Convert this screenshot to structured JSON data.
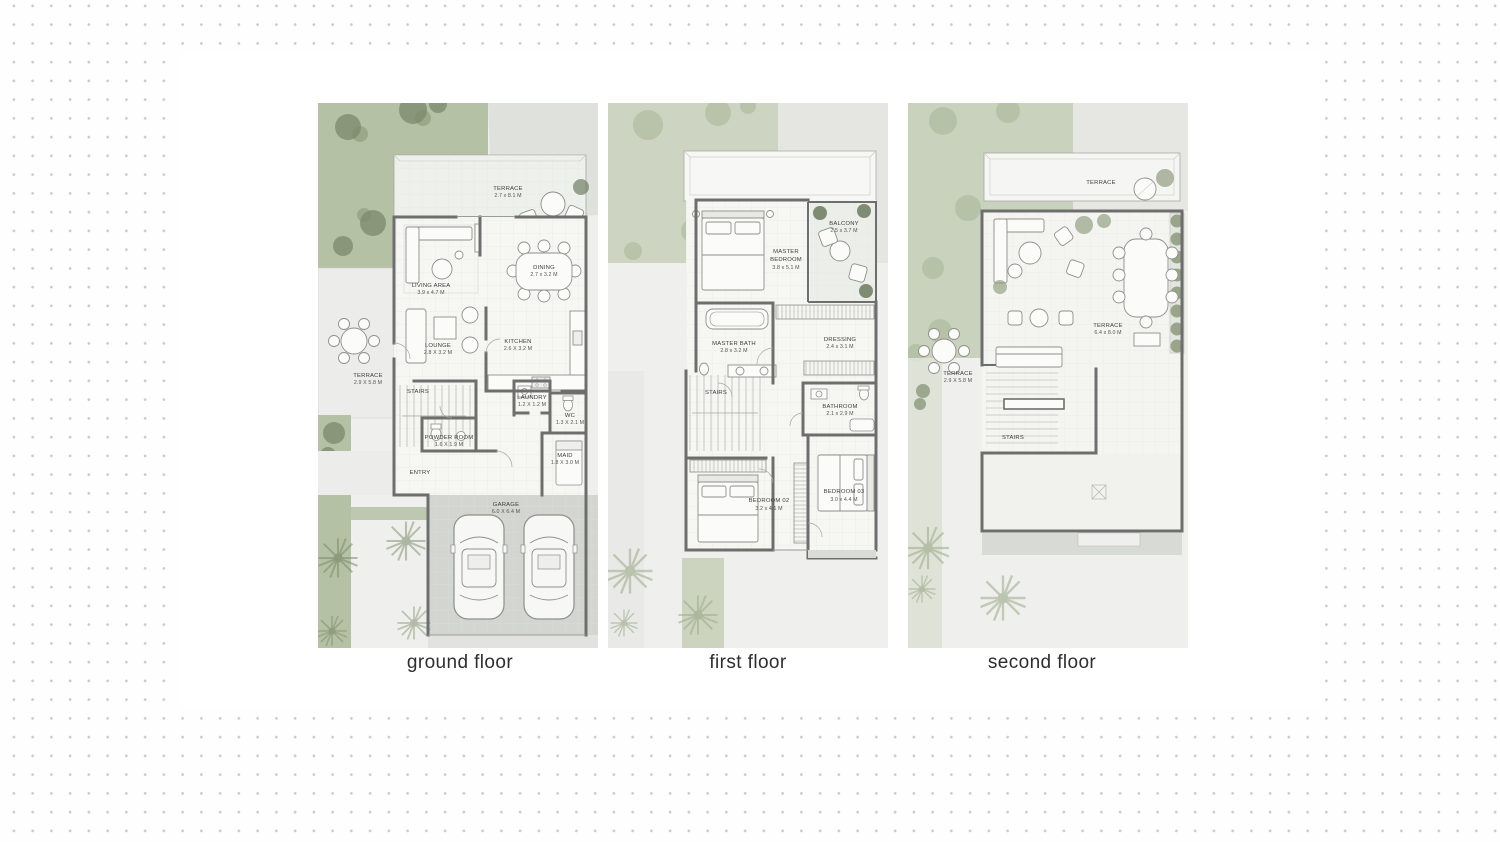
{
  "palette": {
    "dot_color": "#c9c9c9",
    "canvas": "#ffffff",
    "garden_green": "#b5c1a5",
    "garden_green_faded": "#cdd5c2",
    "tree_green": "#5c6c4e",
    "paving_gray": "#dfe1dd",
    "wall_gray": "#6e6e6e",
    "floor_white": "#f6f6f3",
    "garage_gray": "#d3d5d1",
    "room_label_text": "#3f3f3d",
    "floor_label_text": "#2e2e2e"
  },
  "plans": [
    {
      "id": "ground-floor",
      "label": "ground floor",
      "rooms": [
        {
          "name": "TERRACE",
          "dim": "2.7 x 8.1 M"
        },
        {
          "name": "LIVING AREA",
          "dim": "3.9 x 4.7 M"
        },
        {
          "name": "DINING",
          "dim": "2.7 x 3.2 M"
        },
        {
          "name": "LOUNGE",
          "dim": "2.8 X 3.2 M"
        },
        {
          "name": "KITCHEN",
          "dim": "2.6 X 3.2 M"
        },
        {
          "name": "TERRACE",
          "dim": "2.9 X 5.8 M"
        },
        {
          "name": "STAIRS",
          "dim": ""
        },
        {
          "name": "LAUNDRY",
          "dim": "1.2 X 1.2 M"
        },
        {
          "name": "WC",
          "dim": "1.3 X 2.1 M"
        },
        {
          "name": "POWDER ROOM",
          "dim": "1.6 X 1.9 M"
        },
        {
          "name": "MAID",
          "dim": "1.8 X 3.0 M"
        },
        {
          "name": "ENTRY",
          "dim": ""
        },
        {
          "name": "GARAGE",
          "dim": "6.0 X 6.4 M"
        }
      ]
    },
    {
      "id": "first-floor",
      "label": "first floor",
      "rooms": [
        {
          "name": "MASTER",
          "name2": "BEDROOM",
          "dim": "3.8 x 5.1 M"
        },
        {
          "name": "BALCONY",
          "dim": "2.5 x 3.7 M"
        },
        {
          "name": "MASTER BATH",
          "dim": "2.8 x 3.2 M"
        },
        {
          "name": "DRESSING",
          "dim": "2.4 x 3.1 M"
        },
        {
          "name": "STAIRS",
          "dim": ""
        },
        {
          "name": "BATHROOM",
          "dim": "2.1 x 2.9 M"
        },
        {
          "name": "BEDROOM 02",
          "dim": "3.2 x 4.1 M"
        },
        {
          "name": "BEDROOM 03",
          "dim": "3.0 x 4.4 M"
        }
      ]
    },
    {
      "id": "second-floor",
      "label": "second floor",
      "rooms": [
        {
          "name": "TERRACE",
          "dim": ""
        },
        {
          "name": "TERRACE",
          "dim": "6.4 x 8.0 M"
        },
        {
          "name": "TERRACE",
          "dim": "2.9 X 5.8 M"
        },
        {
          "name": "STAIRS",
          "dim": ""
        }
      ]
    }
  ]
}
